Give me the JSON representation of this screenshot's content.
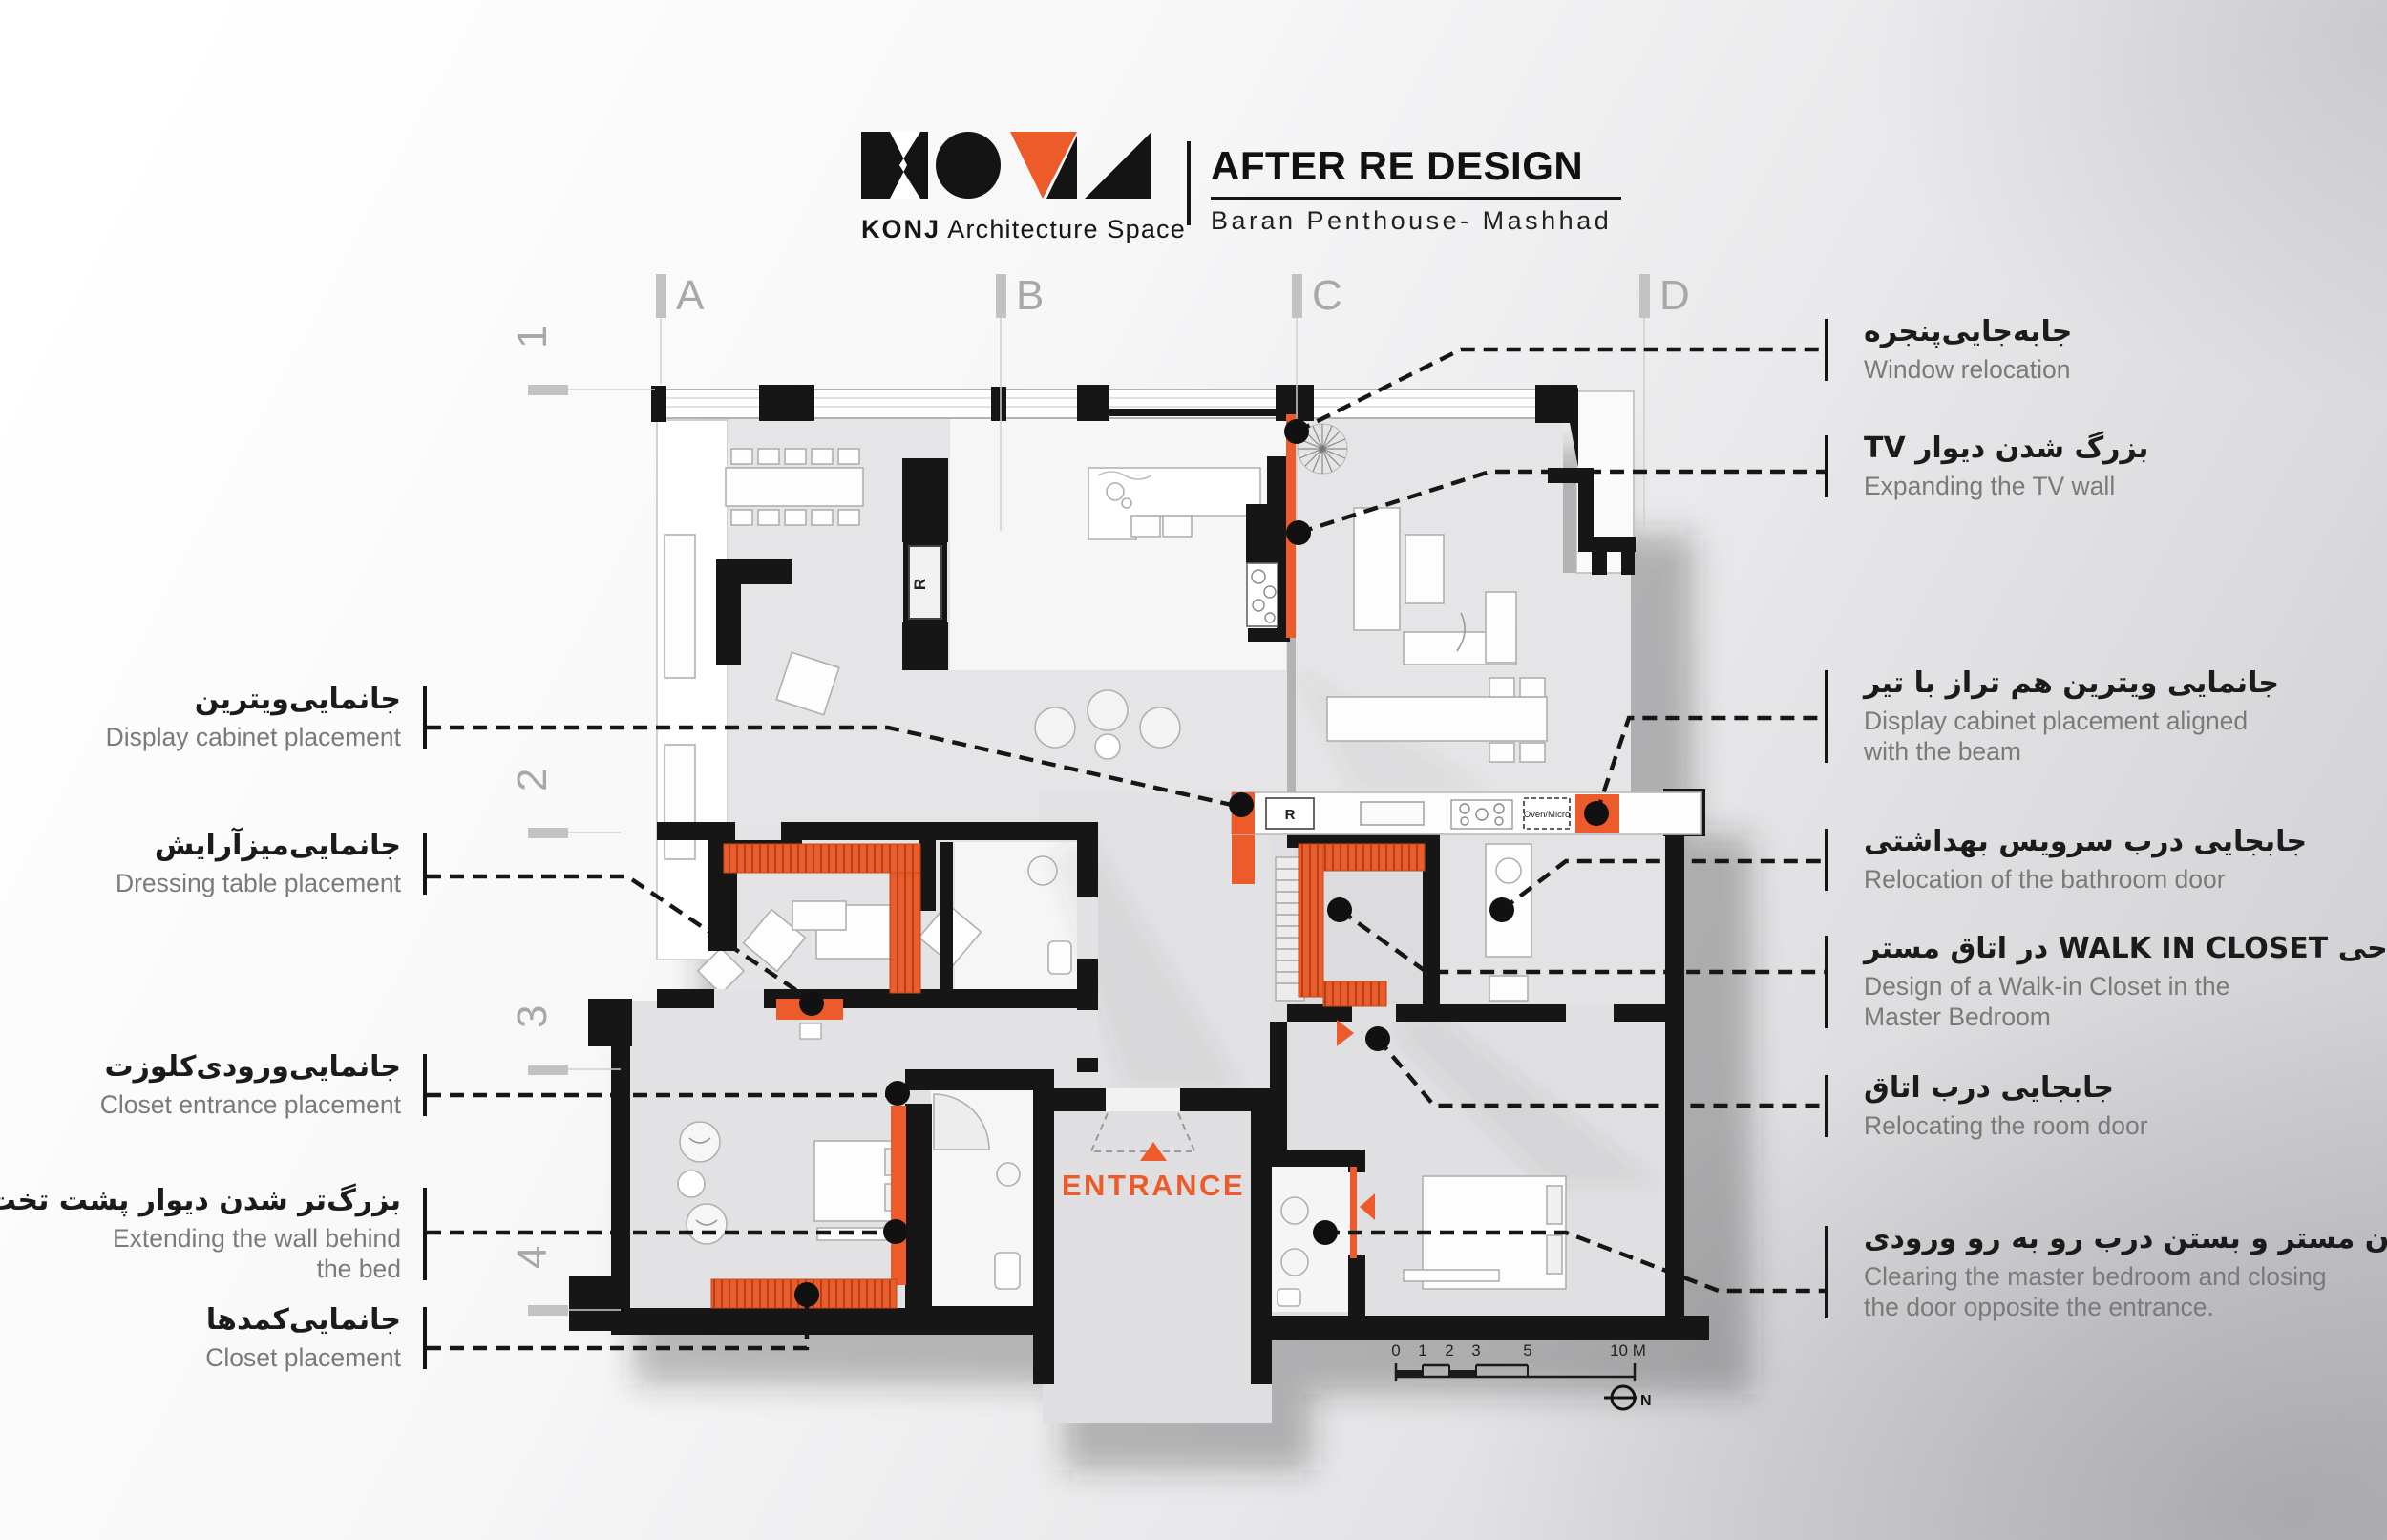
{
  "header": {
    "logo_brand_bold": "KONJ",
    "logo_brand_rest": "Architecture Space",
    "title": "AFTER RE DESIGN",
    "subtitle": "Baran Penthouse- Mashhad"
  },
  "grid": {
    "columns": [
      "A",
      "B",
      "C",
      "D"
    ],
    "rows": [
      "1",
      "2",
      "3",
      "4"
    ]
  },
  "annotations": {
    "left": [
      {
        "fa": "جانمایی‌ویترین",
        "en": "Display cabinet placement"
      },
      {
        "fa": "جانمایی‌میزآرایش",
        "en": "Dressing table placement"
      },
      {
        "fa": "جانمایی‌ورودی‌کلوزت",
        "en": "Closet entrance placement"
      },
      {
        "fa": "بزرگ‌تر شدن دیوار پشت تخت",
        "en": "Extending the wall behind\nthe bed"
      },
      {
        "fa": "جانمایی‌کمدها",
        "en": "Closet placement"
      }
    ],
    "right": [
      {
        "fa": "جابه‌جایی‌پنجره",
        "en": "Window relocation"
      },
      {
        "fa": "بزرگ شدن دیوار TV",
        "en": "Expanding the TV wall"
      },
      {
        "fa": "جانمایی ویترین هم تراز با تیر",
        "en": "Display cabinet placement aligned\nwith the beam"
      },
      {
        "fa": "جابجایی درب سرویس بهداشتی",
        "en": "Relocation of the bathroom door"
      },
      {
        "fa": "طراحی WALK IN CLOSET در اتاق مستر",
        "en": "Design of a Walk-in Closet in the\nMaster Bedroom"
      },
      {
        "fa": "جابجایی درب اتاق",
        "en": "Relocating the room door"
      },
      {
        "fa": "شفاف کردن مستر و بستن درب رو به رو ورودی",
        "en": "Clearing the master bedroom and closing\nthe door opposite the entrance."
      }
    ]
  },
  "plan": {
    "entrance_label": "ENTRANCE",
    "fridge_label": "R",
    "oven_label": "Oven/Micro",
    "north_label": "N"
  },
  "scale": {
    "labels": [
      "0",
      "1",
      "2",
      "3",
      "5",
      "10 M"
    ]
  },
  "colors": {
    "accent": "#ED5B2B",
    "wall": "#161616",
    "floor": "#E5E5E7",
    "annotation_en_text": "#7A7A7A"
  }
}
